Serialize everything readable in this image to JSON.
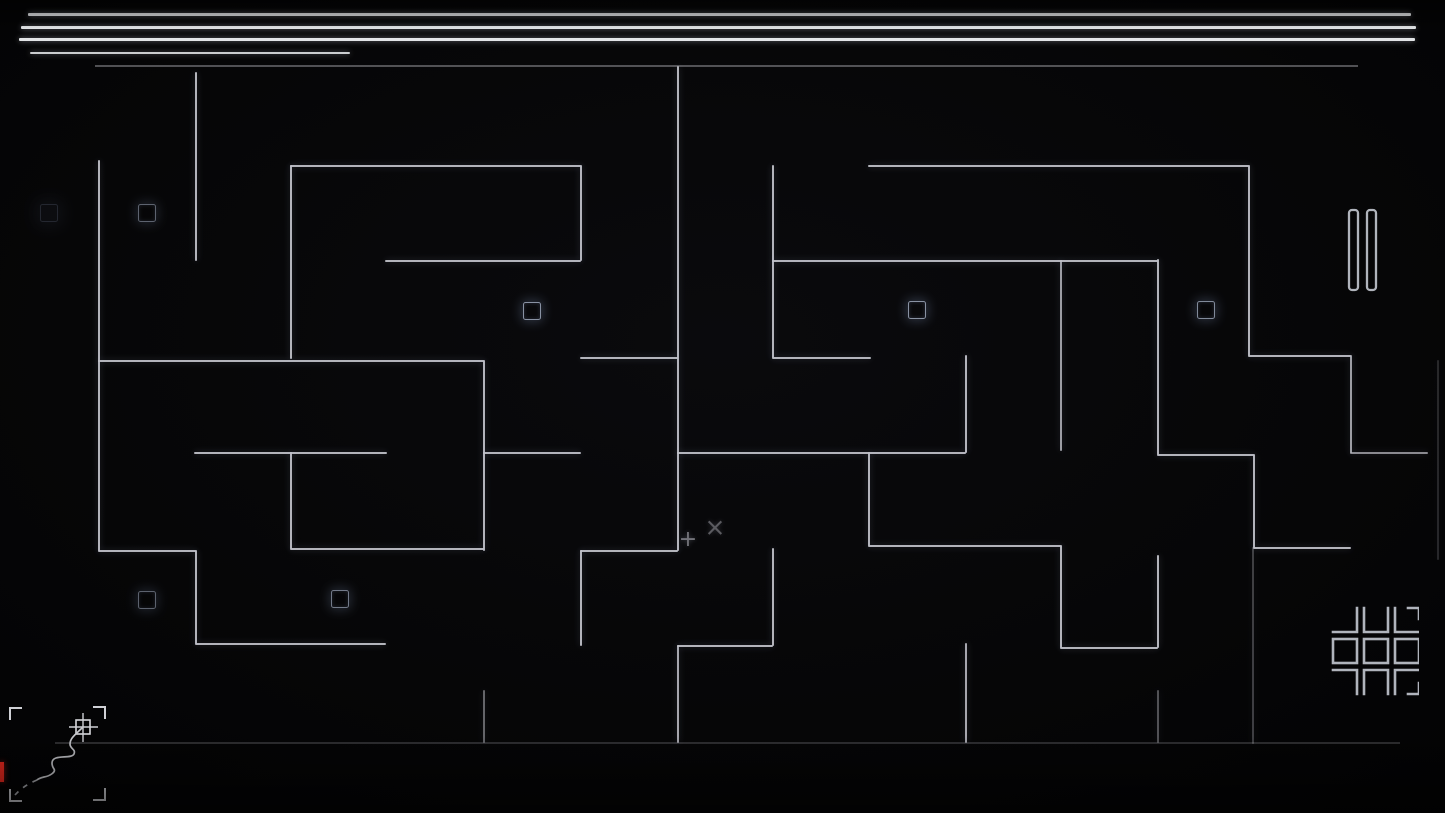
{
  "meta": {
    "screen": "maze-gameplay"
  },
  "colors": {
    "background": "#050507",
    "wall": "#c2c3cb",
    "header_line": "#eef0f3",
    "marker": "#97a1b4",
    "icon": "#b0b4bc",
    "red_tick": "#e8281e",
    "glyph": "#8e8e96"
  },
  "header": {
    "lines": [
      {
        "x": 28,
        "y": 13,
        "w": 1383,
        "h": 2.6,
        "o": 1
      },
      {
        "x": 21,
        "y": 26,
        "w": 1395,
        "h": 2.6,
        "o": 1
      },
      {
        "x": 19,
        "y": 38,
        "w": 1396,
        "h": 2.6,
        "o": 0.95
      },
      {
        "x": 30,
        "y": 52,
        "w": 320,
        "h": 2.2,
        "o": 0.85
      }
    ]
  },
  "maze": {
    "boundaries": [
      {
        "x": 95,
        "y": 65,
        "w": 1263,
        "h": 1.6,
        "o": 0.4
      },
      {
        "x": 55,
        "y": 742,
        "w": 1345,
        "h": 1.6,
        "o": 0.22
      }
    ],
    "walls": [
      {
        "x": 98,
        "y": 160,
        "h": 391
      },
      {
        "x": 195,
        "y": 72,
        "h": 189
      },
      {
        "x": 290,
        "y": 165,
        "h": 194
      },
      {
        "x": 580,
        "y": 165,
        "h": 96
      },
      {
        "x": 483,
        "y": 360,
        "h": 191
      },
      {
        "x": 195,
        "y": 550,
        "h": 94
      },
      {
        "x": 290,
        "y": 452,
        "h": 97
      },
      {
        "x": 483,
        "y": 690,
        "h": 53,
        "o": 0.5
      },
      {
        "x": 677,
        "y": 66,
        "h": 485
      },
      {
        "x": 580,
        "y": 550,
        "h": 96
      },
      {
        "x": 868,
        "y": 452,
        "h": 94
      },
      {
        "x": 772,
        "y": 165,
        "h": 193
      },
      {
        "x": 1060,
        "y": 260,
        "h": 191,
        "o": 0.8
      },
      {
        "x": 1060,
        "y": 545,
        "h": 103
      },
      {
        "x": 1157,
        "y": 555,
        "h": 93
      },
      {
        "x": 965,
        "y": 355,
        "h": 98
      },
      {
        "x": 965,
        "y": 643,
        "h": 100,
        "o": 0.85
      },
      {
        "x": 1157,
        "y": 259,
        "h": 196
      },
      {
        "x": 1253,
        "y": 454,
        "h": 94
      },
      {
        "x": 1252,
        "y": 547,
        "h": 197,
        "o": 0.3
      },
      {
        "x": 772,
        "y": 548,
        "h": 98
      },
      {
        "x": 677,
        "y": 645,
        "h": 98,
        "o": 0.85
      },
      {
        "x": 1248,
        "y": 165,
        "h": 191
      },
      {
        "x": 1350,
        "y": 355,
        "h": 98,
        "o": 0.8
      },
      {
        "x": 1157,
        "y": 690,
        "h": 53,
        "o": 0.4
      },
      {
        "x": 1437,
        "y": 360,
        "h": 200,
        "o": 0.18
      },
      {
        "x": 290,
        "y": 165,
        "w": 291
      },
      {
        "x": 385,
        "y": 260,
        "w": 196
      },
      {
        "x": 98,
        "y": 360,
        "w": 386
      },
      {
        "x": 98,
        "y": 550,
        "w": 98
      },
      {
        "x": 195,
        "y": 643,
        "w": 191
      },
      {
        "x": 194,
        "y": 452,
        "w": 193
      },
      {
        "x": 290,
        "y": 548,
        "w": 194
      },
      {
        "x": 483,
        "y": 452,
        "w": 98
      },
      {
        "x": 580,
        "y": 357,
        "w": 98
      },
      {
        "x": 580,
        "y": 550,
        "w": 98
      },
      {
        "x": 677,
        "y": 452,
        "w": 289
      },
      {
        "x": 868,
        "y": 545,
        "w": 193
      },
      {
        "x": 1060,
        "y": 647,
        "w": 98
      },
      {
        "x": 868,
        "y": 165,
        "w": 381
      },
      {
        "x": 772,
        "y": 260,
        "w": 386
      },
      {
        "x": 772,
        "y": 357,
        "w": 99
      },
      {
        "x": 1157,
        "y": 454,
        "w": 97
      },
      {
        "x": 1253,
        "y": 547,
        "w": 98
      },
      {
        "x": 1248,
        "y": 355,
        "w": 103
      },
      {
        "x": 1350,
        "y": 452,
        "w": 78,
        "o": 0.7
      },
      {
        "x": 677,
        "y": 645,
        "w": 96
      }
    ],
    "markers": [
      {
        "cx": 48,
        "cy": 212,
        "s": 16,
        "o": 0.35,
        "type": "dim"
      },
      {
        "cx": 146,
        "cy": 212,
        "s": 16,
        "o": 0.6
      },
      {
        "cx": 531,
        "cy": 310,
        "s": 16,
        "o": 0.9
      },
      {
        "cx": 916,
        "cy": 309,
        "s": 16,
        "o": 0.9
      },
      {
        "cx": 1205,
        "cy": 309,
        "s": 16,
        "o": 0.85
      },
      {
        "cx": 146,
        "cy": 599,
        "s": 16,
        "o": 0.6
      },
      {
        "cx": 339,
        "cy": 598,
        "s": 16,
        "o": 0.75
      }
    ]
  },
  "player": {
    "plus_marker": {
      "glyph": "+",
      "x": 688,
      "y": 540
    },
    "cross_marker": {
      "glyph": "×",
      "x": 715,
      "y": 527
    }
  },
  "hud": {
    "pause_button": {
      "name": "pause",
      "x": 1347,
      "y": 208
    },
    "menu_button": {
      "name": "level-grid",
      "x": 1331,
      "y": 606
    },
    "minimap": {
      "x": 0,
      "y": 695,
      "trail_solid": "M83,32 C76,39 70,43 70,49 C70,54 76,54 74,59 C72,63 62,61 56,63 C50,65 52,71 54,74 C56,77 50,81 44,82 C40,83 38,84 37,85",
      "trail_dashed": "M37,85 C30,88 22,92 15,100",
      "red_tick": {
        "x": 0,
        "y": 762,
        "w": 3.5,
        "h": 20,
        "o": 1
      }
    }
  }
}
